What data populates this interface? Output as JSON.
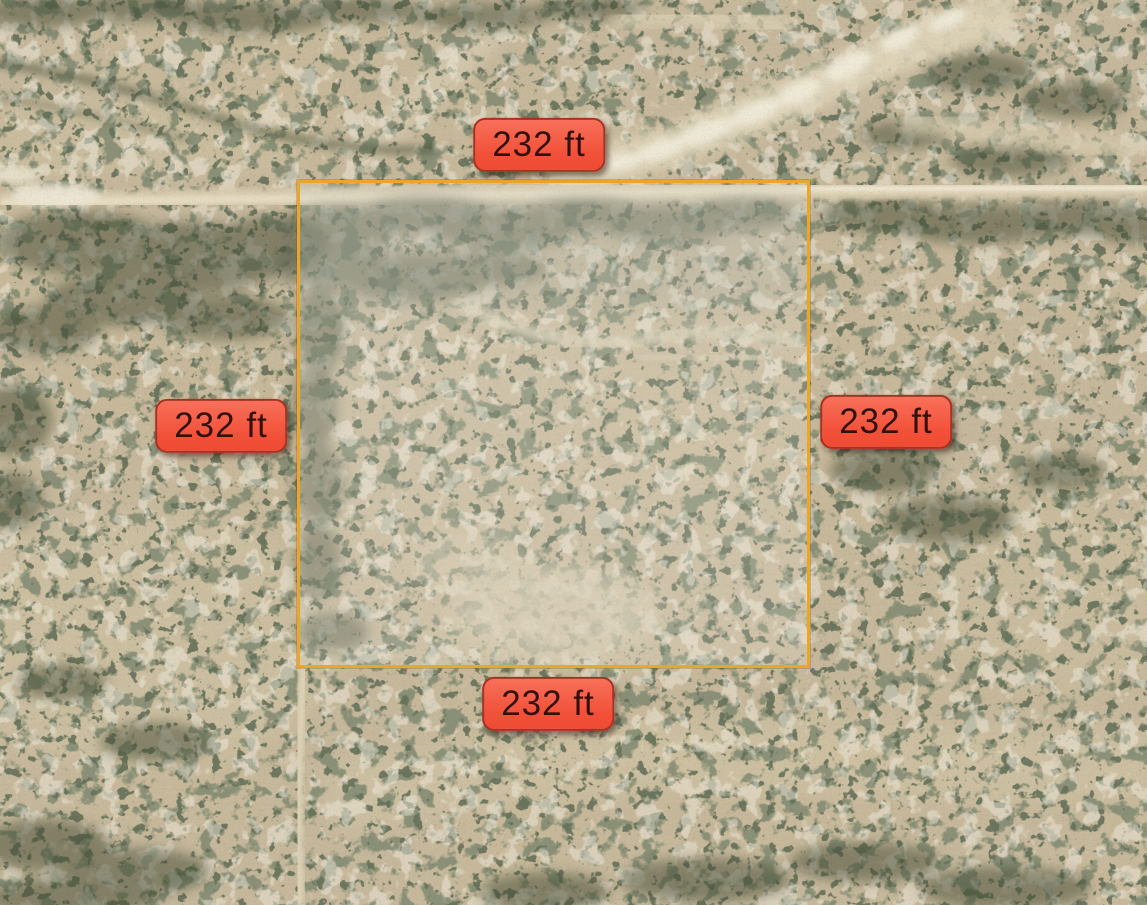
{
  "scene": {
    "kind": "satellite-aerial-view",
    "subject": "Square desert land parcel outlined in orange on satellite imagery with red dimension badges on all four sides"
  },
  "parcel": {
    "outline_color": "#E8A72C",
    "highlight_fill": "rgba(255,255,255,0.15)",
    "side_length_ft": 232
  },
  "dimension_labels": [
    {
      "side": "top",
      "text": "232 ft"
    },
    {
      "side": "left",
      "text": "232 ft"
    },
    {
      "side": "right",
      "text": "232 ft"
    },
    {
      "side": "bottom",
      "text": "232 ft"
    }
  ],
  "badge_style": {
    "background": "#F3563E",
    "border": "#A93120",
    "text_color": "#33100A"
  }
}
